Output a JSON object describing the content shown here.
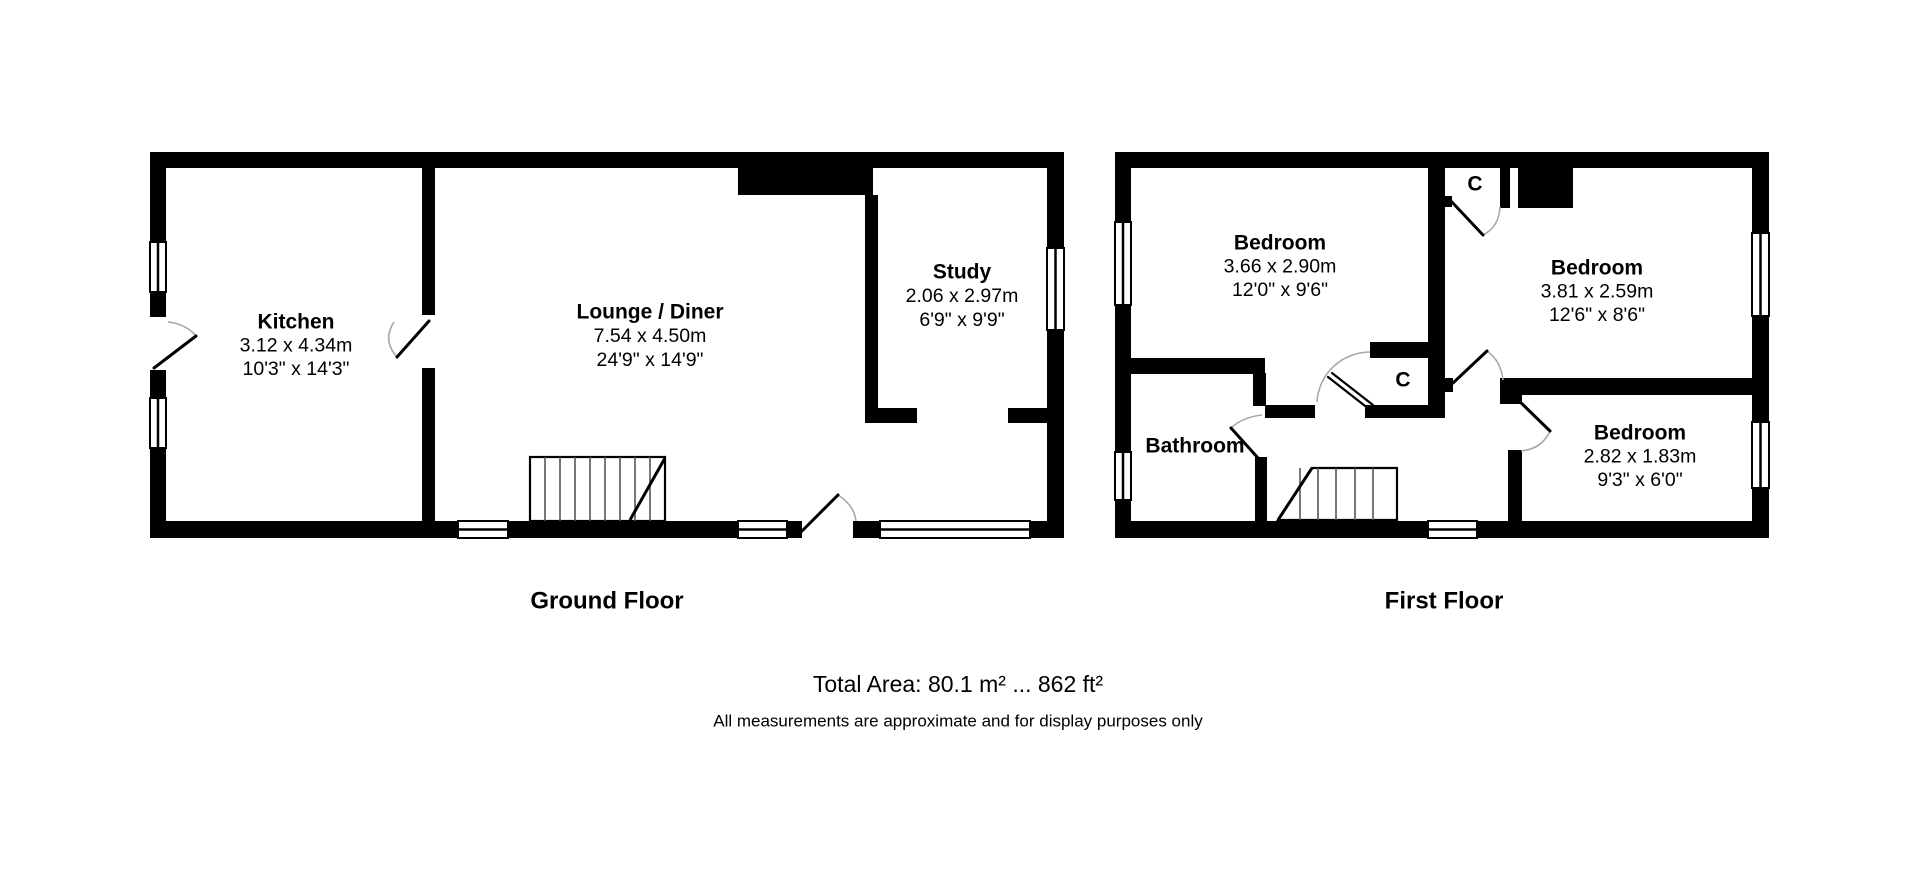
{
  "ground_floor": {
    "label": "Ground Floor",
    "rooms": {
      "kitchen": {
        "name": "Kitchen",
        "metric": "3.12 x 4.34m",
        "imperial": "10'3\" x 14'3\""
      },
      "lounge": {
        "name": "Lounge / Diner",
        "metric": "7.54 x 4.50m",
        "imperial": "24'9\" x 14'9\""
      },
      "study": {
        "name": "Study",
        "metric": "2.06 x 2.97m",
        "imperial": "6'9\" x 9'9\""
      }
    }
  },
  "first_floor": {
    "label": "First Floor",
    "rooms": {
      "bedroom1": {
        "name": "Bedroom",
        "metric": "3.66 x 2.90m",
        "imperial": "12'0\" x 9'6\""
      },
      "bedroom2": {
        "name": "Bedroom",
        "metric": "3.81 x 2.59m",
        "imperial": "12'6\" x 8'6\""
      },
      "bedroom3": {
        "name": "Bedroom",
        "metric": "2.82 x 1.83m",
        "imperial": "9'3\" x 6'0\""
      },
      "bathroom": {
        "name": "Bathroom"
      },
      "closet_top": {
        "label": "C"
      },
      "closet_mid": {
        "label": "C"
      }
    }
  },
  "footer": {
    "total_area": "Total Area: 80.1 m² ... 862 ft²",
    "disclaimer": "All measurements are approximate and for display purposes only"
  },
  "colors": {
    "wall": "#000000",
    "background": "#ffffff",
    "door_arc": "#a8a8a8"
  }
}
